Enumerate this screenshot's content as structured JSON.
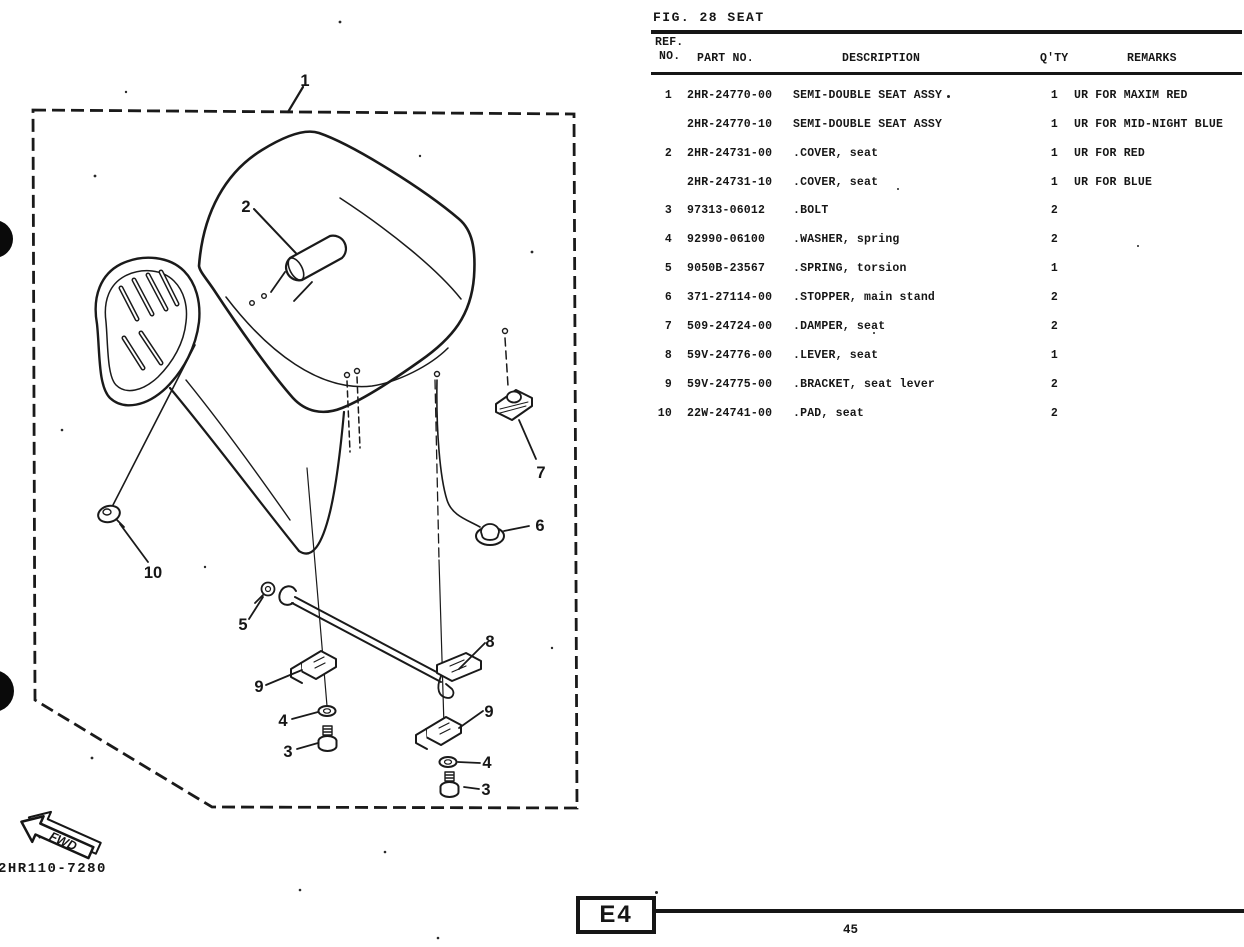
{
  "page": {
    "figure_title": "FIG. 28 SEAT",
    "drawing_number": "2HR110-7280",
    "section_code": "E4",
    "page_number": "45",
    "fwd_label": "FWD"
  },
  "table": {
    "headers": {
      "ref_line1": "REF.",
      "ref_line2": "NO.",
      "part_no": "PART NO.",
      "description": "DESCRIPTION",
      "qty": "Q'TY",
      "remarks": "REMARKS"
    },
    "rows": [
      {
        "ref": "1",
        "part_no": "2HR-24770-00",
        "description": "SEMI-DOUBLE SEAT ASSY",
        "qty": "1",
        "remarks": "UR FOR MAXIM RED"
      },
      {
        "ref": "",
        "part_no": "2HR-24770-10",
        "description": "SEMI-DOUBLE SEAT ASSY",
        "qty": "1",
        "remarks": "UR FOR MID-NIGHT BLUE"
      },
      {
        "ref": "2",
        "part_no": "2HR-24731-00",
        "description": ".COVER, seat",
        "qty": "1",
        "remarks": "UR FOR RED"
      },
      {
        "ref": "",
        "part_no": "2HR-24731-10",
        "description": ".COVER, seat",
        "qty": "1",
        "remarks": "UR FOR BLUE"
      },
      {
        "ref": "3",
        "part_no": "97313-06012",
        "description": ".BOLT",
        "qty": "2",
        "remarks": ""
      },
      {
        "ref": "4",
        "part_no": "92990-06100",
        "description": ".WASHER, spring",
        "qty": "2",
        "remarks": ""
      },
      {
        "ref": "5",
        "part_no": "9050B-23567",
        "description": ".SPRING, torsion",
        "qty": "1",
        "remarks": ""
      },
      {
        "ref": "6",
        "part_no": "371-27114-00",
        "description": ".STOPPER, main stand",
        "qty": "2",
        "remarks": ""
      },
      {
        "ref": "7",
        "part_no": "509-24724-00",
        "description": ".DAMPER, seat",
        "qty": "2",
        "remarks": ""
      },
      {
        "ref": "8",
        "part_no": "59V-24776-00",
        "description": ".LEVER, seat",
        "qty": "1",
        "remarks": ""
      },
      {
        "ref": "9",
        "part_no": "59V-24775-00",
        "description": ".BRACKET, seat lever",
        "qty": "2",
        "remarks": ""
      },
      {
        "ref": "10",
        "part_no": "22W-24741-00",
        "description": ".PAD, seat",
        "qty": "2",
        "remarks": ""
      }
    ]
  },
  "diagram": {
    "callouts": [
      "1",
      "2",
      "7",
      "6",
      "10",
      "5",
      "8",
      "9",
      "4",
      "3",
      "9",
      "4",
      "3"
    ]
  }
}
